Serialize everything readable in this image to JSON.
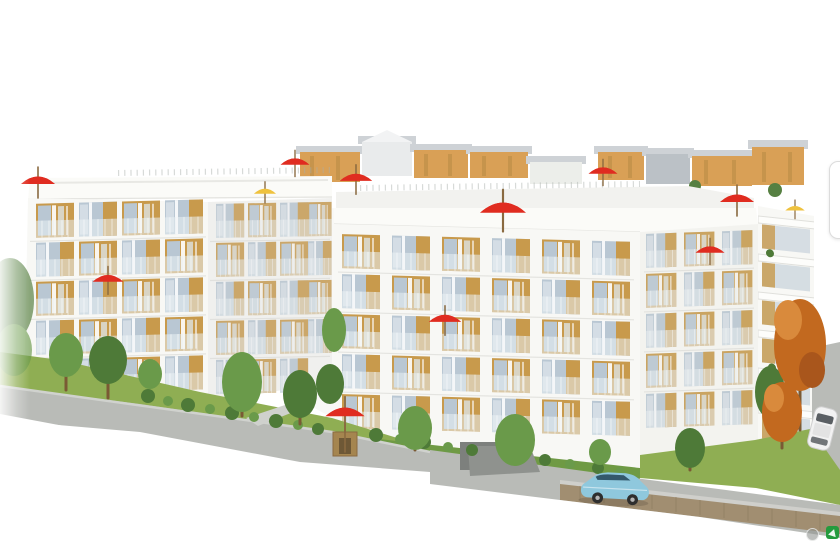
{
  "image": {
    "kind": "architectural 3D rendering",
    "subject": "Two modern white apartment buildings with wood-panel balconies and glass balustrades, rooftop terraces with red and yellow parasols, landscaped lawns with green and autumn trees, sloping grey roads, a light blue car and a white car, in front of a row of tan and grey background houses on a white page background",
    "background": "white"
  },
  "colors": {
    "paper_white": "#ffffff",
    "building_white": "#f8f8f5",
    "building_shade": "#ededea",
    "slab_white": "#fbfbf8",
    "wood": "#c89a4c",
    "wood_dark": "#a87f35",
    "glass": "#b9c7d3",
    "glass_light": "#dfe7ec",
    "railing_glass": "#e9f0f4",
    "grass": "#8fae53",
    "grass_dark": "#6f9a44",
    "tree_green": "#6a9a4a",
    "tree_dark": "#4e7a38",
    "tree_autumn": "#c2691f",
    "trunk_brown": "#7a5a34",
    "road_gray": "#b9bbb7",
    "road_light": "#cfd1cd",
    "wall_brown": "#a18e71",
    "house_tan": "#d79b4d",
    "house_gray": "#b8bec4",
    "roof_gray": "#ccd0d4",
    "umbrella_red": "#e02c20",
    "umbrella_yellow": "#efc23e",
    "car_blue": "#8fc8dd",
    "car_white": "#f2f2f2",
    "watermark_green": "#249b3e",
    "button_border": "#dcdcdc",
    "shade_overlay": "#d8d8d4"
  },
  "scene": {
    "left_building": {
      "name": "left apartment building",
      "floors_visible": 5,
      "facade": "white with recessed wood-panel balconies"
    },
    "right_building": {
      "name": "right apartment building",
      "floors_visible": 6,
      "facade": "white with wood-panel balconies and stacked white balcony slabs on right wing"
    },
    "background_houses": "row of tan and grey gabled houses along the skyline",
    "parasols": {
      "red": 10,
      "yellow": 3
    },
    "cars": [
      {
        "color": "light blue",
        "location": "parked on road in front of right building"
      },
      {
        "color": "white",
        "location": "on sloping road at right edge, partially cut off"
      }
    ],
    "trees": {
      "green": "multiple",
      "autumn_orange": 2
    },
    "ground": [
      "grass lawns with bushes",
      "grey roads with diagonal white cut-off at bottom",
      "timber retaining wall at lower right",
      "garden parasol with wooden kiosk"
    ]
  },
  "overlay": {
    "next_button": {
      "state": "partially visible, clipped at right edge"
    },
    "watermarks": [
      {
        "shape": "grey circle"
      },
      {
        "shape": "green rounded square with white glyph"
      }
    ]
  }
}
